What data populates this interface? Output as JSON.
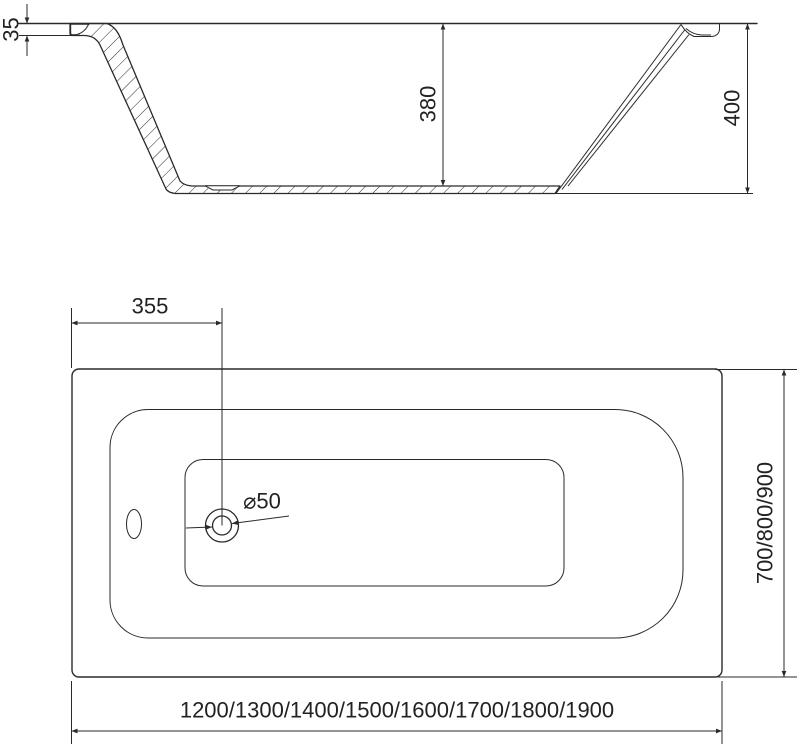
{
  "colors": {
    "ink": "#2a2a2a",
    "background": "#ffffff"
  },
  "section_view": {
    "rim_thickness": "35",
    "internal_depth": "380",
    "total_height": "400"
  },
  "plan_view": {
    "drain_offset_from_left": "355",
    "drain_diameter": "⌀50",
    "width_options": "700/800/900",
    "length_options": "1200/1300/1400/1500/1600/1700/1800/1900"
  }
}
